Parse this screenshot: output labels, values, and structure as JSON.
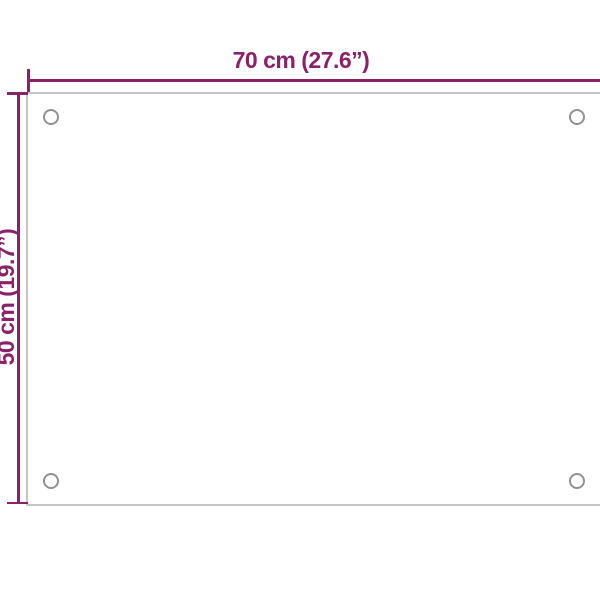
{
  "diagram": {
    "type": "product-dimension-diagram",
    "width_label": "70 cm (27.6”)",
    "height_label": "50 cm (19.7”)",
    "holes_visible": 4,
    "colors": {
      "dimension": "#8b2269",
      "panel_edge": "#c5c5c5",
      "hole_edge": "#919191",
      "background": "#ffffff"
    }
  }
}
